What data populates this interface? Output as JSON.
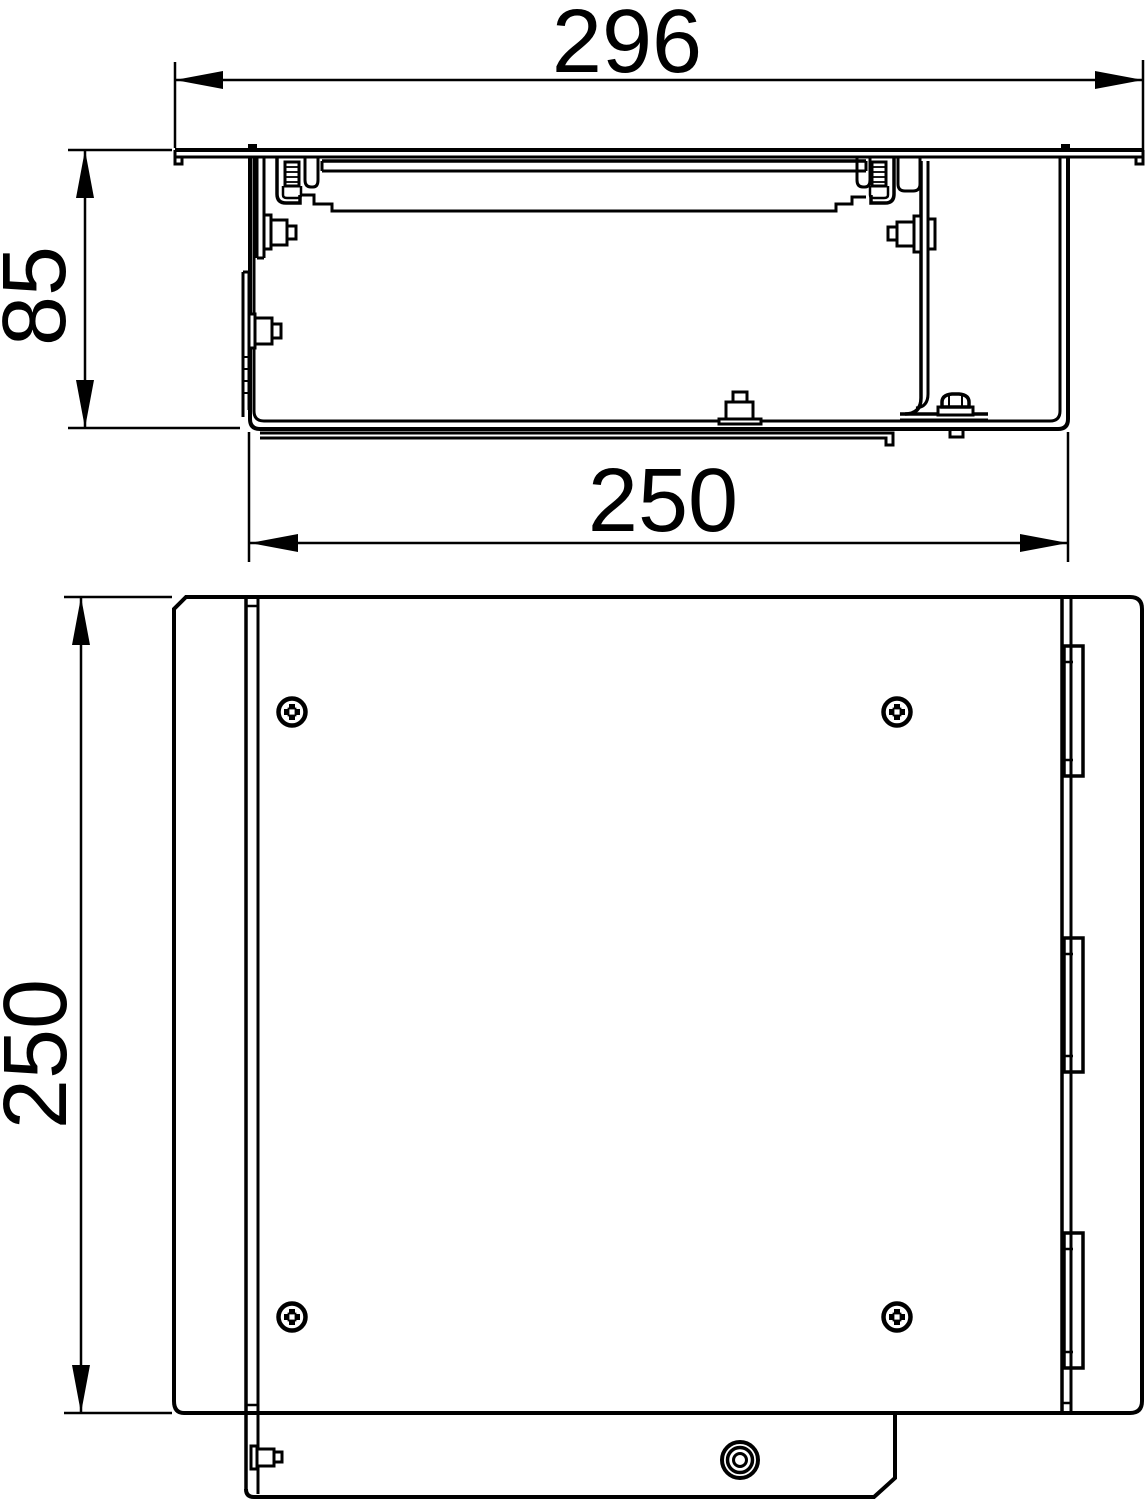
{
  "colors": {
    "line": "#000000",
    "background": "#ffffff"
  },
  "section_view": {
    "dims": {
      "overall_width": "296",
      "height": "85",
      "body_width": "250"
    }
  },
  "plan_view": {
    "dims": {
      "depth": "250"
    }
  }
}
